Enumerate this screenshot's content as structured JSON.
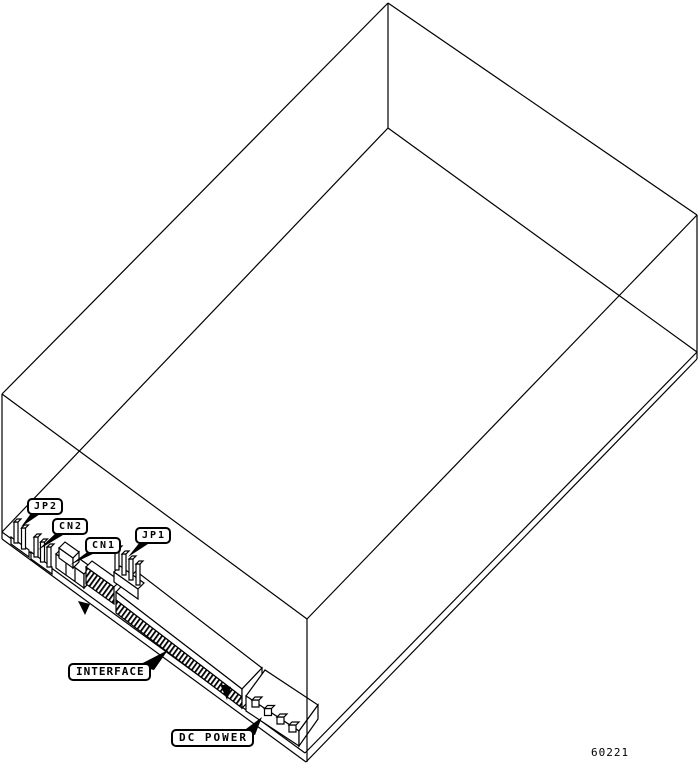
{
  "diagram": {
    "callouts": {
      "jp2": "JP2",
      "cn2": "CN2",
      "cn1": "CN1",
      "jp1": "JP1",
      "interface": "INTERFACE",
      "dc_power": "DC POWER"
    },
    "figure_number": "60221",
    "colors": {
      "line": "#000000",
      "background": "#ffffff"
    }
  }
}
